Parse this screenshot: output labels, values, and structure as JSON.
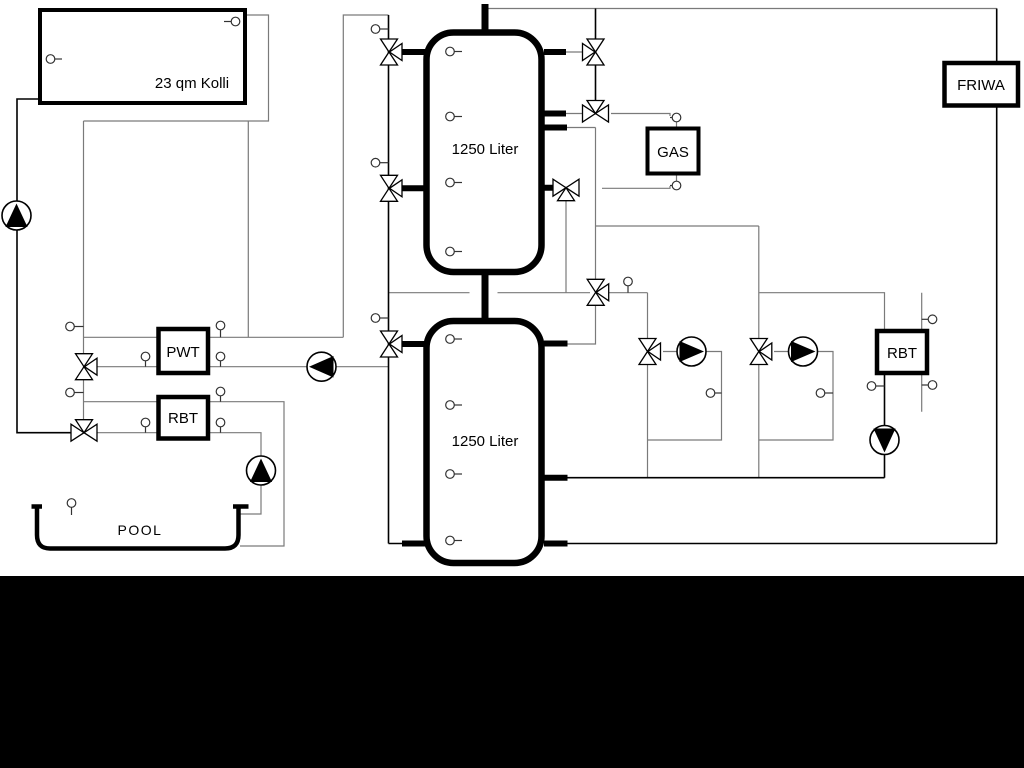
{
  "labels": {
    "collector": "23 qm Kolli",
    "tank_upper": "1250 Liter",
    "tank_lower": "1250 Liter",
    "gas": "GAS",
    "friwa": "FRIWA",
    "heat_exchanger_pwt": "PWT",
    "rbt_left": "RBT",
    "rbt_right": "RBT",
    "pool": "POOL"
  },
  "colors": {
    "line_gray": "#7a7a7a",
    "line_black": "#000000",
    "fill_white": "#ffffff",
    "letterbox": "#000000",
    "background": "#ffffff"
  },
  "icons": {
    "pump": "circle-with-solid-triangle",
    "three_way_valve": "triple-triangle-bowtie",
    "sensor": "small-circle-with-stem"
  }
}
